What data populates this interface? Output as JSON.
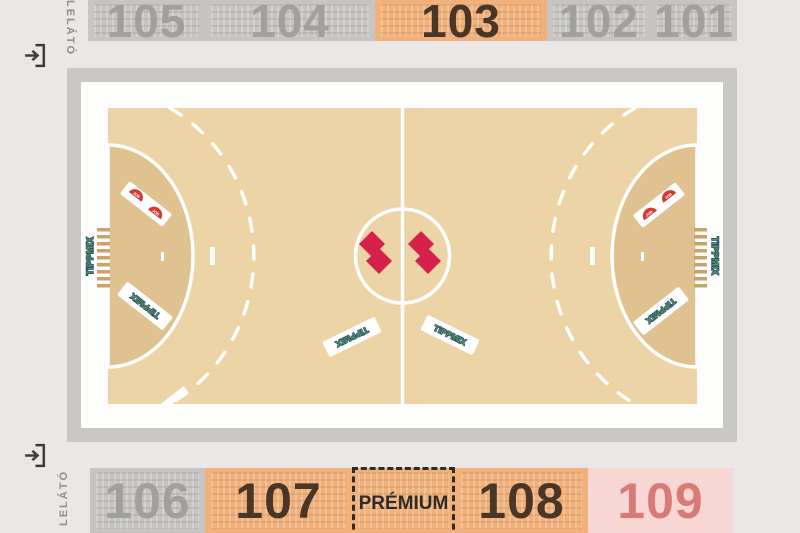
{
  "stands": {
    "top": {
      "label": "LELÁTÓ",
      "sections": [
        {
          "label": "105",
          "state": "default",
          "fill": "#c6c5c3",
          "text_color": "#a2a09e"
        },
        {
          "label": "104",
          "state": "default",
          "fill": "#c6c5c3",
          "text_color": "#a2a09e"
        },
        {
          "label": "103",
          "state": "highlighted",
          "fill": "#f2b17b",
          "text_color": "#4a3626"
        },
        {
          "label": "102",
          "state": "default",
          "fill": "#c6c5c3",
          "text_color": "#a2a09e"
        },
        {
          "label": "101",
          "state": "default",
          "fill": "#c6c5c3",
          "text_color": "#a2a09e"
        }
      ]
    },
    "bottom": {
      "label": "LELÁTÓ",
      "sections": [
        {
          "label": "106",
          "state": "default",
          "fill": "#c6c5c3",
          "text_color": "#a2a09e"
        },
        {
          "label": "107",
          "state": "highlighted",
          "fill": "#f2b17b",
          "text_color": "#4a3626"
        },
        {
          "label": "PRÉMIUM",
          "state": "premium",
          "fill": "#f2b17b",
          "text_color": "#2e2b28"
        },
        {
          "label": "108",
          "state": "highlighted",
          "fill": "#f2b17b",
          "text_color": "#4a3626"
        },
        {
          "label": "109",
          "state": "pink",
          "fill": "#f8d6d4",
          "text_color": "#d87b78"
        }
      ]
    }
  },
  "court": {
    "ads": {
      "brand": "TiPPMIX",
      "fan_label": "JOB"
    }
  },
  "icons": {
    "entrance_icon": "arrow-entering-bracket"
  },
  "colors": {
    "background": "#e9e8e6",
    "stand_gray": "#c6c5c3",
    "highlight_orange": "#f2b17b",
    "premium_pink": "#f8d6d4",
    "arena_frame_gray": "#cac8c6",
    "court_tan": "#ecd4a6",
    "goal_area_tan": "#dfc28f",
    "line_white": "#ffffff",
    "brand_green": "#4aa03c",
    "brand_blue": "#2a3a85",
    "club_logo_red": "#d6224a",
    "fan_logo_red": "#d23a33"
  }
}
